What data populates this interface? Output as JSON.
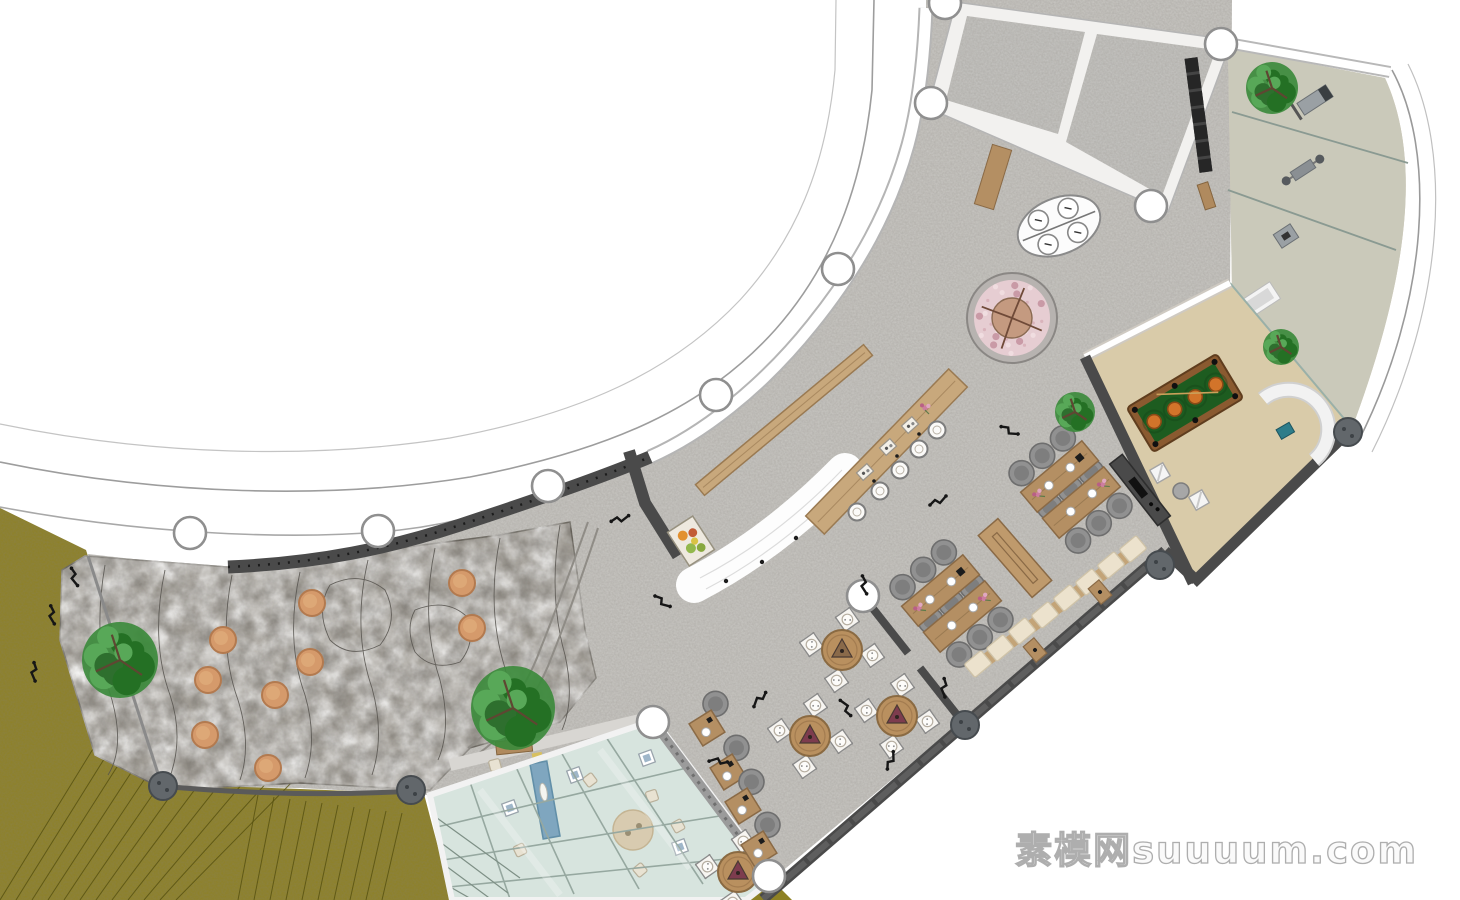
{
  "watermark": {
    "text": "素模网suuuum.com"
  },
  "palette": {
    "floor_gray": "#c9c7c3",
    "wall_dark": "#4a4a4a",
    "wall_white": "#ffffff",
    "lawn_olive": "#8e8124",
    "rock_gray": "#a5a19a",
    "wood": "#b48f63",
    "wood_light": "#c8a87c",
    "gym_floor": "#d6cec0",
    "glass_green": "#d7e4de",
    "pool_felt": "#1d5c20",
    "pool_lamp": "#d2742a",
    "cushion_cream": "#ece2cd",
    "chair_gray": "#919191",
    "stool_orange": "#d59a6b",
    "blossom_pink": "#e6cdd2"
  },
  "plan": {
    "structure": {
      "columns": [
        [
          190,
          533
        ],
        [
          378,
          531
        ],
        [
          548,
          486
        ],
        [
          716,
          395
        ],
        [
          838,
          269
        ],
        [
          931,
          103
        ],
        [
          945,
          3
        ],
        [
          1221,
          44
        ],
        [
          1151,
          206
        ],
        [
          769,
          876
        ],
        [
          653,
          722
        ],
        [
          863,
          596
        ]
      ],
      "bollards": [
        [
          163,
          786
        ],
        [
          411,
          790
        ],
        [
          965,
          725
        ],
        [
          1160,
          565
        ],
        [
          1348,
          432
        ]
      ],
      "floor_lamps": [
        [
          938,
          500
        ],
        [
          1010,
          430
        ],
        [
          865,
          585
        ],
        [
          760,
          700
        ],
        [
          718,
          762
        ],
        [
          845,
          708
        ],
        [
          890,
          760
        ],
        [
          620,
          518
        ],
        [
          663,
          601
        ],
        [
          945,
          688
        ]
      ],
      "slope_marks": [
        [
          75,
          577
        ],
        [
          53,
          615
        ],
        [
          35,
          672
        ]
      ]
    },
    "rock_garden": {
      "stools": [
        [
          312,
          603
        ],
        [
          223,
          640
        ],
        [
          310,
          662
        ],
        [
          208,
          680
        ],
        [
          275,
          695
        ],
        [
          205,
          735
        ],
        [
          268,
          768
        ],
        [
          462,
          583
        ],
        [
          472,
          628
        ]
      ],
      "tree": {
        "x": 120,
        "y": 660,
        "r": 38
      }
    },
    "trees": [
      {
        "x": 513,
        "y": 708,
        "r": 42
      },
      {
        "x": 1272,
        "y": 88,
        "r": 26
      },
      {
        "x": 1281,
        "y": 347,
        "r": 18
      },
      {
        "x": 1075,
        "y": 412,
        "r": 20
      }
    ],
    "blossom_planter": {
      "x": 1012,
      "y": 318,
      "outer_r": 45,
      "canopy_r": 38,
      "trunk_r": 20
    },
    "oval_booth": {
      "x": 1059,
      "y": 226,
      "rx": 43,
      "ry": 28,
      "rot": -22
    },
    "bar": {
      "table": {
        "x1": 815,
        "y1": 525,
        "x2": 958,
        "y2": 378,
        "width": 26
      },
      "divider": {
        "x1": 700,
        "y1": 490,
        "x2": 868,
        "y2": 350,
        "width": 14
      },
      "stools": [
        [
          857,
          512
        ],
        [
          880,
          491
        ],
        [
          900,
          470
        ],
        [
          919,
          449
        ],
        [
          937,
          430
        ]
      ],
      "trays": [
        [
          865,
          472
        ],
        [
          888,
          447
        ],
        [
          910,
          425
        ]
      ],
      "flower": [
        925,
        408
      ]
    },
    "dining": {
      "clusters": [
        {
          "tables": [
            [
              1059,
              502
            ],
            [
              1082,
              477
            ]
          ],
          "rot": -40
        },
        {
          "tables": [
            [
              940,
              590
            ],
            [
              963,
              617
            ]
          ],
          "rot": -40
        }
      ],
      "console": {
        "x": 1015,
        "y": 558,
        "w": 82,
        "h": 26,
        "rot": 49
      },
      "round_tables": [
        {
          "x": 842,
          "y": 650,
          "tri": "#8a6a4a"
        },
        {
          "x": 897,
          "y": 716,
          "tri": "#7d3c4e"
        },
        {
          "x": 810,
          "y": 736,
          "tri": "#7d3c4e"
        },
        {
          "x": 738,
          "y": 872,
          "tri": "#7d3c4e"
        }
      ],
      "square_tables": [
        [
          707,
          728
        ],
        [
          728,
          772
        ],
        [
          743,
          806
        ],
        [
          759,
          849
        ]
      ],
      "bench": {
        "rot": 50,
        "cushions": [
          [
            978,
            664
          ],
          [
            1000,
            648
          ],
          [
            1022,
            631
          ],
          [
            1045,
            615
          ],
          [
            1067,
            598
          ],
          [
            1089,
            582
          ],
          [
            1111,
            565
          ],
          [
            1133,
            549
          ]
        ],
        "side_tables": [
          [
            1035,
            650
          ],
          [
            1100,
            592
          ]
        ]
      }
    },
    "billiards": {
      "table": {
        "x": 1185,
        "y": 403,
        "w": 105,
        "h": 52,
        "rot": -31,
        "lamps": 4
      },
      "chairs": [
        [
          1160,
          473
        ],
        [
          1199,
          500
        ]
      ],
      "stool": [
        1181,
        491
      ],
      "counter": {
        "x": 1140,
        "y": 490,
        "w": 78,
        "h": 16,
        "rot": 52
      }
    },
    "gym": {
      "equipment": [
        "treadmill",
        "bench-press",
        "stepper",
        "massage-bed"
      ]
    },
    "glass_room": {
      "water": {
        "x": 545,
        "y": 800,
        "rot": -10
      },
      "rug": [
        633,
        830
      ],
      "cushions": [
        [
          495,
          765
        ],
        [
          520,
          850
        ],
        [
          590,
          780
        ],
        [
          652,
          796
        ],
        [
          678,
          826
        ],
        [
          640,
          870
        ]
      ],
      "frames": [
        [
          510,
          808
        ],
        [
          575,
          775
        ],
        [
          647,
          758
        ],
        [
          680,
          847
        ]
      ]
    }
  }
}
